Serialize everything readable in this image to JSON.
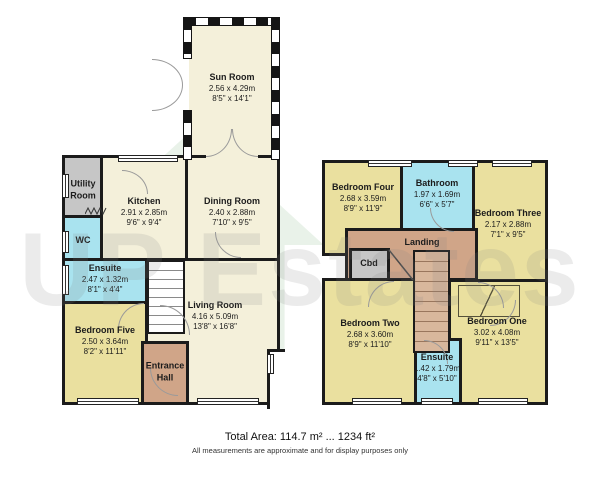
{
  "watermark": {
    "text": "UP Estates",
    "logo": "house-icon"
  },
  "footer": {
    "total_area": "Total Area: 114.7 m² ... 1234 ft²",
    "disclaimer": "All measurements are approximate and for display purposes only"
  },
  "colors": {
    "wall": "#1b1b1b",
    "room_cream": "#f4f0da",
    "bedroom_yellow": "#eae09f",
    "wet_cyan": "#a9e3ef",
    "hall_brown": "#d0a588",
    "store_grey": "#c6c6c6"
  },
  "ground_floor": {
    "rooms": [
      {
        "name": "Sun Room",
        "metric": "2.56 x 4.29m",
        "imperial": "8'5\" x 14'1\""
      },
      {
        "name": "Utility Room",
        "metric": "",
        "imperial": ""
      },
      {
        "name": "WC",
        "metric": "",
        "imperial": ""
      },
      {
        "name": "Kitchen",
        "metric": "2.91 x 2.85m",
        "imperial": "9'6\" x 9'4\""
      },
      {
        "name": "Dining Room",
        "metric": "2.40 x 2.88m",
        "imperial": "7'10\" x 9'5\""
      },
      {
        "name": "Ensuite",
        "metric": "2.47 x 1.32m",
        "imperial": "8'1\" x 4'4\""
      },
      {
        "name": "Bedroom Five",
        "metric": "2.50 x 3.64m",
        "imperial": "8'2\" x 11'11\""
      },
      {
        "name": "Living Room",
        "metric": "4.16 x 5.09m",
        "imperial": "13'8\" x 16'8\""
      },
      {
        "name": "Entrance Hall",
        "metric": "",
        "imperial": ""
      }
    ]
  },
  "first_floor": {
    "rooms": [
      {
        "name": "Bedroom Four",
        "metric": "2.68 x 3.59m",
        "imperial": "8'9\" x 11'9\""
      },
      {
        "name": "Bathroom",
        "metric": "1.97 x 1.69m",
        "imperial": "6'6\" x 5'7\""
      },
      {
        "name": "Bedroom Three",
        "metric": "2.17 x 2.88m",
        "imperial": "7'1\" x 9'5\""
      },
      {
        "name": "Landing",
        "metric": "",
        "imperial": ""
      },
      {
        "name": "Cbd",
        "metric": "",
        "imperial": ""
      },
      {
        "name": "Bedroom Two",
        "metric": "2.68 x 3.60m",
        "imperial": "8'9\" x 11'10\""
      },
      {
        "name": "Ensuite",
        "metric": "1.42 x 1.79m",
        "imperial": "4'8\" x 5'10\""
      },
      {
        "name": "Bedroom One",
        "metric": "3.02 x 4.08m",
        "imperial": "9'11\" x 13'5\""
      }
    ]
  }
}
